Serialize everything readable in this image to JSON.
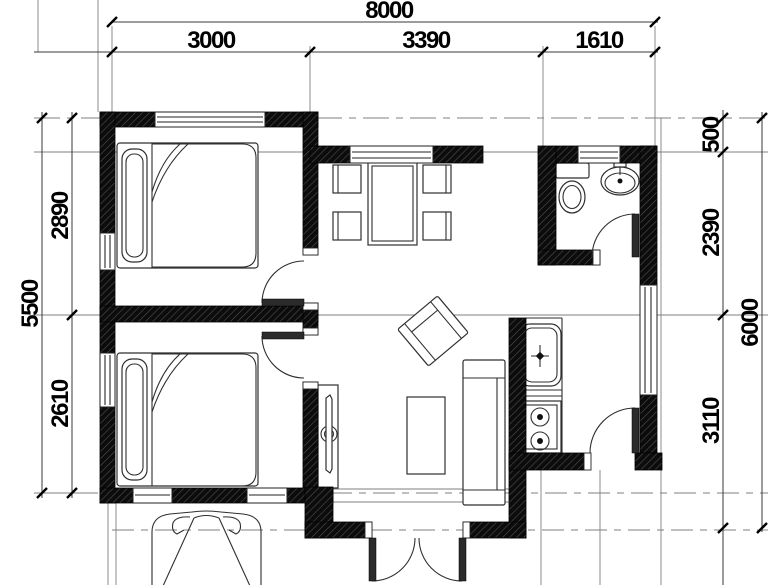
{
  "title": "house-floor-plan",
  "colors": {
    "wall_fill": "#0c0c0c",
    "wall_hatch": "#4a4a4a",
    "dimension_line": "#3a3a3a",
    "grid_line": "#7f7f7f",
    "background": "#ffffff",
    "text": "#000000"
  },
  "dimensions": {
    "top": {
      "total": "8000",
      "segments": [
        "3000",
        "3390",
        "1610"
      ]
    },
    "left": {
      "total": "5500",
      "segments": [
        "2890",
        "2610"
      ]
    },
    "right": {
      "total": "6000",
      "segments": [
        "500",
        "2390",
        "3110"
      ]
    }
  },
  "fixtures": [
    "double-bed",
    "double-bed",
    "dining-table",
    "dining-chair",
    "dining-chair",
    "dining-chair",
    "dining-chair",
    "armchair",
    "coffee-table",
    "sofa",
    "tv-cabinet",
    "kitchen-sink",
    "cooktop",
    "toilet",
    "washbasin",
    "car"
  ]
}
